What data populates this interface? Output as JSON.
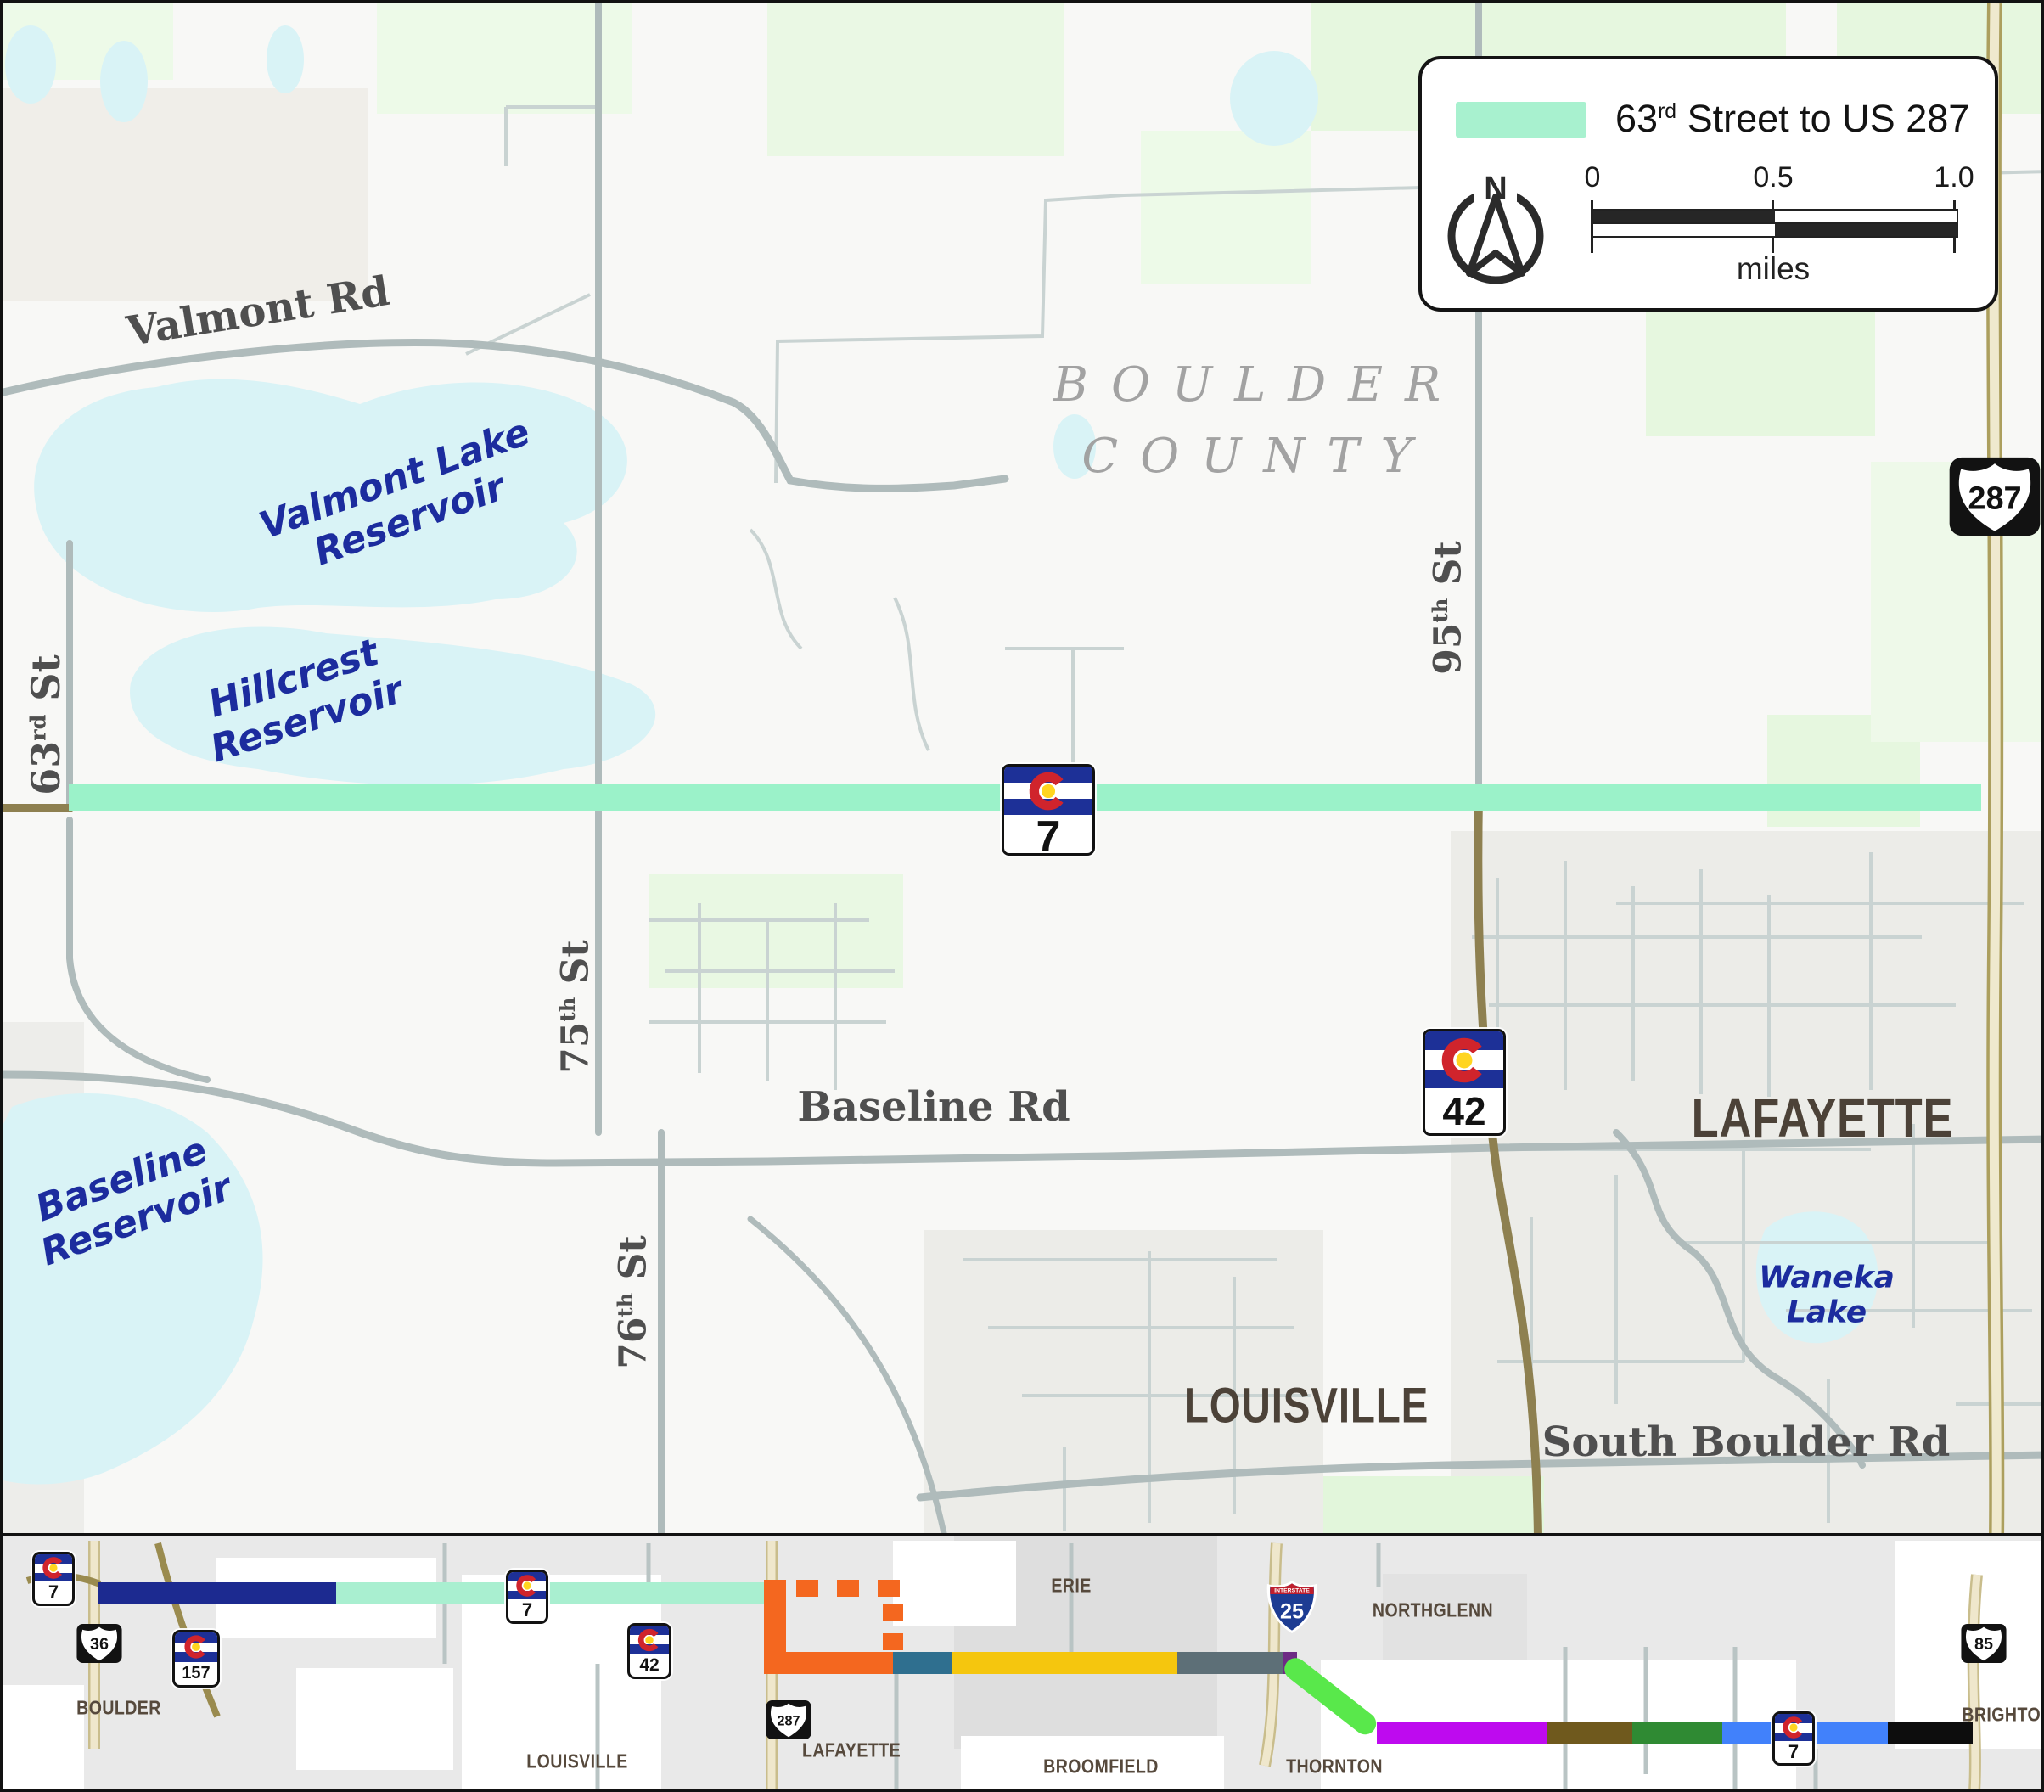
{
  "colors": {
    "corridor": "#9BF2C9",
    "legend_swatch": "#A8F1CF",
    "water": "#D9F3F6"
  },
  "legend": {
    "title_pre": "63",
    "title_sup": "rd",
    "title_post": " Street to US 287",
    "north": "N",
    "scale_0": "0",
    "scale_half": "0.5",
    "scale_one": "1.0",
    "scale_unit": "miles"
  },
  "map": {
    "county_line1": "BOULDER",
    "county_line2": "COUNTY",
    "roads": {
      "valmont": "Valmont Rd",
      "baseline": "Baseline Rd",
      "south_boulder": "South Boulder Rd"
    },
    "streets": {
      "s63": {
        "num": "63",
        "sup": "rd",
        "suffix": " St"
      },
      "s75": {
        "num": "75",
        "sup": "th",
        "suffix": " St"
      },
      "s76": {
        "num": "76",
        "sup": "th",
        "suffix": " St"
      },
      "s95": {
        "num": "95",
        "sup": "th",
        "suffix": " St"
      }
    },
    "cities": {
      "lafayette": "LAFAYETTE",
      "louisville": "LOUISVILLE"
    },
    "waters": {
      "valmont": {
        "line1": "Valmont Lake",
        "line2": "Reservoir"
      },
      "hillcrest": {
        "line1": "Hillcrest",
        "line2": "Reservoir"
      },
      "baseline": {
        "line1": "Baseline",
        "line2": "Reservoir"
      },
      "waneka": {
        "line1": "Waneka",
        "line2": "Lake"
      }
    },
    "shields": {
      "co7": "7",
      "co42": "42",
      "us287": "287"
    }
  },
  "strip": {
    "cities": {
      "boulder": "BOULDER",
      "louisville": "LOUISVILLE",
      "lafayette": "LAFAYETTE",
      "erie": "ERIE",
      "broomfield": "BROOMFIELD",
      "northglenn": "NORTHGLENN",
      "thornton": "THORNTON",
      "brighton": "BRIGHTON"
    },
    "shields": {
      "co7": "7",
      "us36": "36",
      "co157": "157",
      "co42": "42",
      "us287": "287",
      "i25": "25",
      "us85": "85",
      "interstate": "INTERSTATE"
    },
    "segments": [
      {
        "name": "navy",
        "color": "#1C2A90"
      },
      {
        "name": "mint",
        "color": "#A9EFD0"
      },
      {
        "name": "orange",
        "color": "#F4671F"
      },
      {
        "name": "teal",
        "color": "#2F6F8F"
      },
      {
        "name": "yellow",
        "color": "#F5C60E"
      },
      {
        "name": "slate",
        "color": "#5D6F77"
      },
      {
        "name": "purple",
        "color": "#6E2B85"
      },
      {
        "name": "bright-green",
        "color": "#59E84B"
      },
      {
        "name": "magenta",
        "color": "#BE0AEF"
      },
      {
        "name": "brown",
        "color": "#6F591D"
      },
      {
        "name": "forest-green",
        "color": "#2F8A33"
      },
      {
        "name": "blue",
        "color": "#4181FB"
      },
      {
        "name": "black",
        "color": "#0D0D0D"
      }
    ]
  }
}
